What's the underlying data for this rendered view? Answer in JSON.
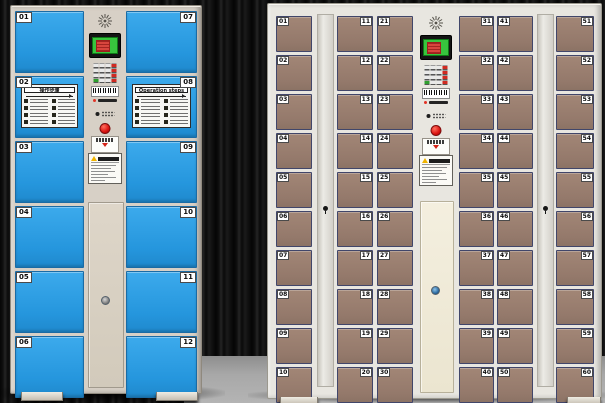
{
  "scene": {
    "description": "Two smart electronic storage locker cabinets in front of a dark striped backdrop on a gray floor",
    "wall_color": "#101010",
    "floor_color": "#a8a8a8"
  },
  "left_cabinet": {
    "kind": "12-door electronic locker",
    "frame_color": "#d7d0c6",
    "door_color": "#2ba1e8",
    "service_door_color": "#d9d1c3",
    "columns": [
      {
        "label_side": "left",
        "doors": [
          "01",
          "02",
          "03",
          "04",
          "05",
          "06"
        ]
      },
      {
        "label_side": "right",
        "doors": [
          "07",
          "08",
          "09",
          "10",
          "11",
          "12"
        ]
      }
    ],
    "stickers": [
      {
        "door": "02",
        "title": "操作步骤",
        "steps": 8
      },
      {
        "door": "08",
        "title": "Operation steps",
        "steps": 8
      }
    ],
    "panel": {
      "components": [
        "speaker-grille",
        "lcd-display",
        "keypad",
        "barcode-scanner",
        "sensor-leds",
        "open-button",
        "pickup-label",
        "warning-sticker"
      ],
      "screen_color": "#38c53e",
      "button_color": "#da1310",
      "keypad_rows": 4,
      "keypad_cols": 4
    },
    "service_door_keyhole": true
  },
  "right_cabinet": {
    "kind": "60-door electronic locker",
    "frame_color": "#e8e6e0",
    "door_color": "#9c8173",
    "service_door_color": "#f3eedd",
    "columns": [
      {
        "label_side": "left",
        "doors": [
          "01",
          "02",
          "03",
          "04",
          "05",
          "06",
          "07",
          "08",
          "09",
          "10"
        ]
      },
      {
        "label_side": "right",
        "doors": [
          "11",
          "12",
          "13",
          "14",
          "15",
          "16",
          "17",
          "18",
          "19",
          "20"
        ]
      },
      {
        "label_side": "left",
        "doors": [
          "21",
          "22",
          "23",
          "24",
          "25",
          "26",
          "27",
          "28",
          "29",
          "30"
        ]
      },
      {
        "label_side": "right",
        "doors": [
          "31",
          "32",
          "33",
          "34",
          "35",
          "36",
          "37",
          "38",
          "39",
          "40"
        ]
      },
      {
        "label_side": "left",
        "doors": [
          "41",
          "42",
          "43",
          "44",
          "45",
          "46",
          "47",
          "48",
          "49",
          "50"
        ]
      },
      {
        "label_side": "right",
        "doors": [
          "51",
          "52",
          "53",
          "54",
          "55",
          "56",
          "57",
          "58",
          "59",
          "60"
        ]
      }
    ],
    "lock_strips": 2,
    "panel": {
      "components": [
        "speaker-grille",
        "lcd-display",
        "keypad",
        "barcode-scanner",
        "sensor-leds",
        "open-button",
        "pickup-label",
        "warning-sticker"
      ],
      "screen_color": "#38c53e",
      "button_color": "#da1310",
      "keypad_rows": 4,
      "keypad_cols": 4
    },
    "service_door_keyhole": true
  }
}
